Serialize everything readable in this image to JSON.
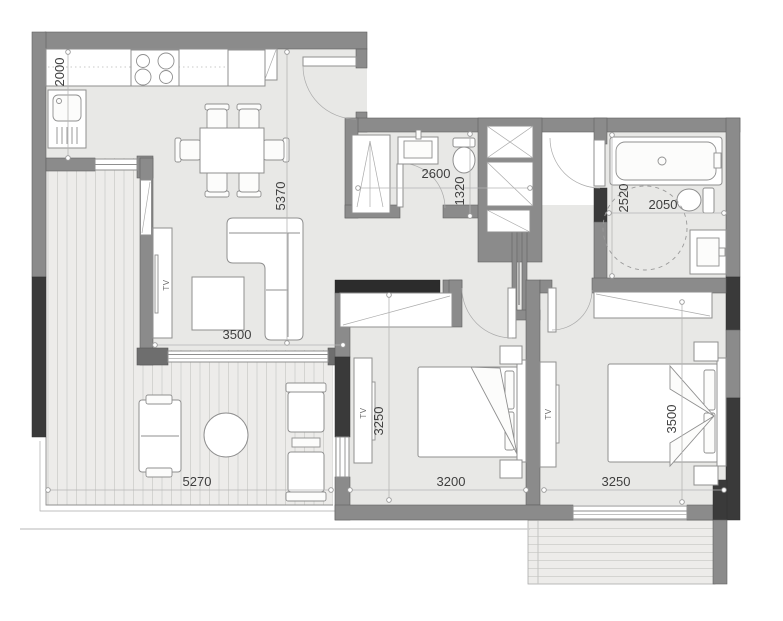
{
  "floor_plan": {
    "type": "apartment-floor-plan",
    "rooms": {
      "kitchen": {
        "dim_depth": "2000"
      },
      "living": {
        "dim_length": "5370",
        "dim_width": "3500",
        "tv_label": "TV"
      },
      "bathroom_1": {
        "dim_width": "2600",
        "dim_depth": "1320"
      },
      "bathroom_2": {
        "dim_depth": "2520",
        "dim_width": "2050"
      },
      "bedroom_1": {
        "dim_depth": "3250",
        "dim_width": "3200",
        "tv_label": "TV"
      },
      "bedroom_2": {
        "dim_depth": "3500",
        "dim_width": "3250",
        "tv_label": "TV"
      },
      "terrace": {
        "dim_width": "5270"
      }
    },
    "colors": {
      "wall": "#8b8b8b",
      "wall_dark": "#3a3a3a",
      "wall_black": "#2c2c2c",
      "floor": "#e8e8e6",
      "terrace_floor": "#edecea",
      "stripe": "#d4d4d1",
      "line": "#8f8f8f",
      "dim_line": "#b5b5b5",
      "text": "#3f3f3f",
      "background": "#ffffff"
    }
  }
}
